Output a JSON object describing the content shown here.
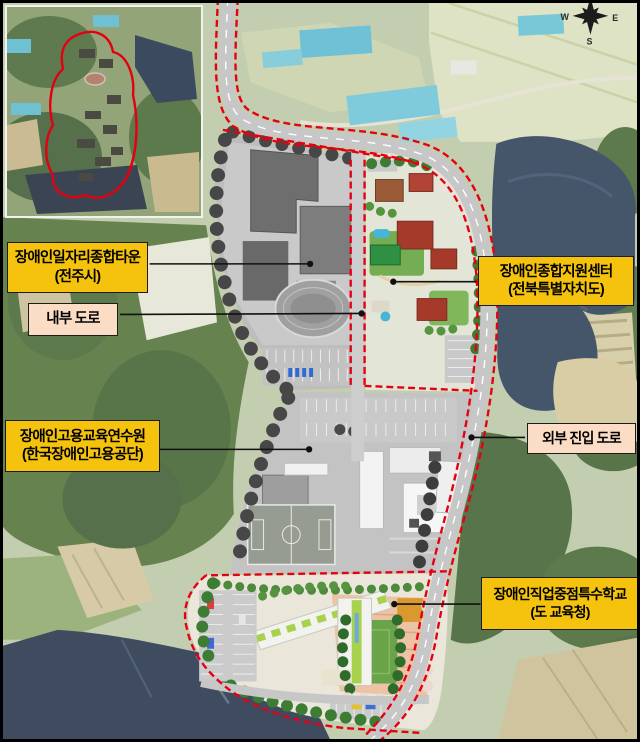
{
  "figure": {
    "title": "장애인 일자리 종합타운 조성 계획도",
    "compass": {
      "west": "W",
      "east": "E",
      "south": "S"
    },
    "labels": {
      "job_town": {
        "line1": "장애인일자리종합타운",
        "line2": "(전주시)"
      },
      "internal_road": {
        "line1": "내부 도로"
      },
      "training_center": {
        "line1": "장애인고용교육연수원",
        "line2": "(한국장애인고용공단)"
      },
      "support_center": {
        "line1": "장애인종합지원센터",
        "line2": "(전북특별자치도)"
      },
      "external_road": {
        "line1": "외부 진입 도로"
      },
      "special_school": {
        "line1": "장애인직업중점특수학교",
        "line2": "(도 교육청)"
      }
    },
    "colors": {
      "label_yellow": "#f5c30d",
      "label_pink": "#fbdcc4",
      "boundary_red": "#e60013",
      "leader_line": "#111111",
      "water": "#45566b",
      "forest": "#5c7a4b",
      "road_gray": "#c7c7c7",
      "site_gray_zone": "#c3c3c3",
      "school_lime": "#a8d24e",
      "plaza_salmon": "#ecc3a4"
    }
  }
}
